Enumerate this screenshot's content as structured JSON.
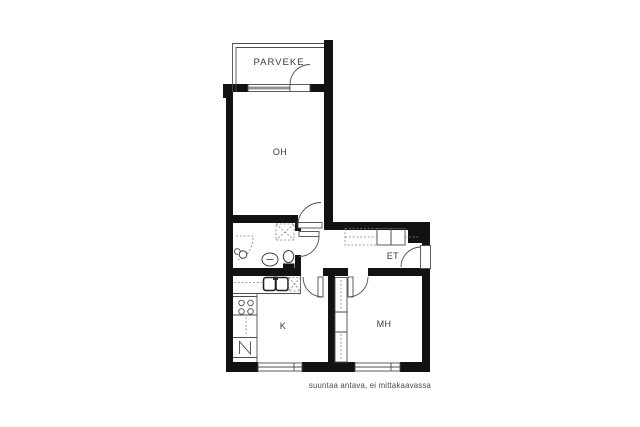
{
  "document": {
    "type": "apartment-floor-plan",
    "background": "#ffffff"
  },
  "colors": {
    "wall": "#121212",
    "thin_line": "#4d4d4d",
    "dashed_line": "#828282",
    "label_text": "#3a3a3a",
    "note_text": "#4a4a4a"
  },
  "rooms": {
    "balcony": {
      "label": "PARVEKE"
    },
    "living_room": {
      "label": "OH"
    },
    "entry": {
      "label": "ET"
    },
    "kitchen": {
      "label": "K"
    },
    "bedroom": {
      "label": "MH"
    }
  },
  "footnote": {
    "text": "suuntaa antava, ei mittakaavassa"
  },
  "fixtures": [
    "shower-icon",
    "washbasin-icon",
    "toilet-icon",
    "washing-machine-reservation-icon",
    "kitchen-sink-icon",
    "stove-icon",
    "refrigerator-icon",
    "wardrobe",
    "window",
    "door-swing"
  ]
}
